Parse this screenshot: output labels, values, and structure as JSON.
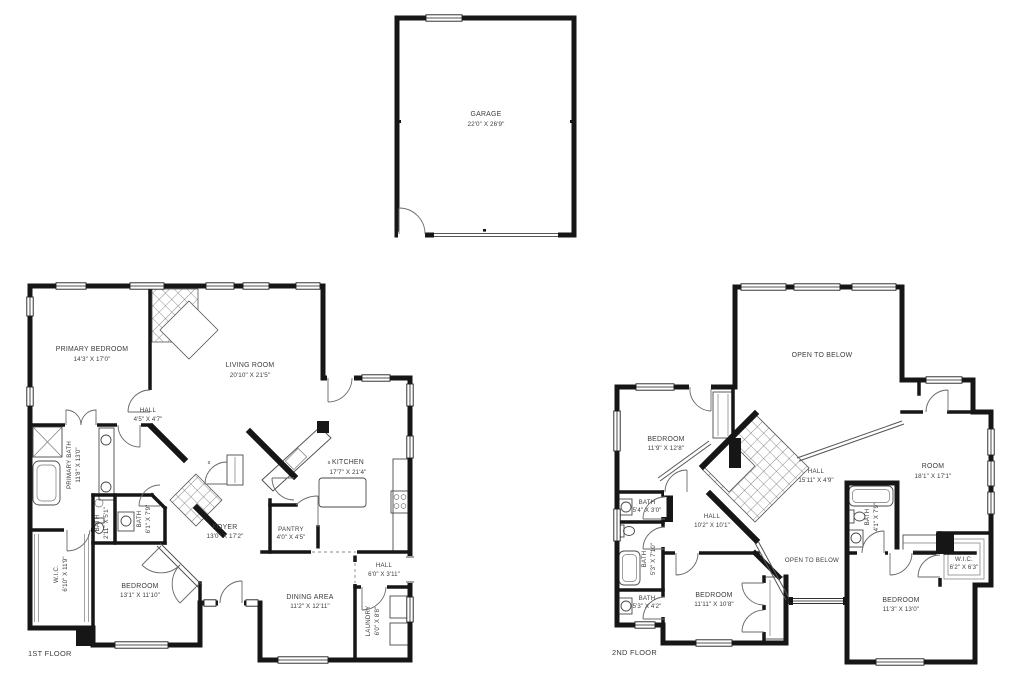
{
  "colors": {
    "wall": "#161616",
    "label": "#3c3c3c",
    "background": "#ffffff"
  },
  "garage": {
    "name": "GARAGE",
    "dims": "22'0\" X 26'9\""
  },
  "floor1": {
    "title": "1ST FLOOR",
    "rooms": {
      "primary_bedroom": {
        "name": "PRIMARY BEDROOM",
        "dims": "14'3\" X 17'0\""
      },
      "living_room": {
        "name": "LIVING ROOM",
        "dims": "20'10\" X 21'5\""
      },
      "hall_small": {
        "name": "HALL",
        "dims": "4'5\" X 4'7\""
      },
      "primary_bath": {
        "name": "PRIMARY BATH",
        "dims": "11'8\" X 13'0\""
      },
      "bath_small": {
        "name": "BATH",
        "dims": "2'11\" X 5'1\""
      },
      "bath_hall": {
        "name": "BATH",
        "dims": "6'1\" X 7'9\""
      },
      "kitchen": {
        "name": "KITCHEN",
        "dims": "17'7\" X 21'4\""
      },
      "foyer": {
        "name": "FOYER",
        "dims": "13'0\" X 17'2\""
      },
      "pantry": {
        "name": "PANTRY",
        "dims": "4'0\" X 4'5\""
      },
      "wic": {
        "name": "W.I.C.",
        "dims": "6'10\" X 11'9\""
      },
      "bedroom": {
        "name": "BEDROOM",
        "dims": "13'1\" X 11'10\""
      },
      "hall_rear": {
        "name": "HALL",
        "dims": "6'0\" X 3'11\""
      },
      "dining": {
        "name": "DINING AREA",
        "dims": "11'2\" X 12'11\""
      },
      "laundry": {
        "name": "LAUNDRY",
        "dims": "6'0\" X 8'8\""
      }
    },
    "markers": {
      "s1": "s",
      "s2": "s"
    }
  },
  "floor2": {
    "title": "2ND FLOOR",
    "rooms": {
      "open_below_top": {
        "name": "OPEN TO BELOW"
      },
      "bedroom_nw": {
        "name": "BEDROOM",
        "dims": "11'9\" X 12'8\""
      },
      "hall_landing": {
        "name": "HALL",
        "dims": "15'11\" X 4'9\""
      },
      "room": {
        "name": "ROOM",
        "dims": "18'1\" X 17'1\""
      },
      "bath_nw": {
        "name": "BATH",
        "dims": "5'4\" X 3'0\""
      },
      "bath_w": {
        "name": "BATH",
        "dims": "5'3\" X 7'10\""
      },
      "hall_center": {
        "name": "HALL",
        "dims": "10'2\" X 10'1\""
      },
      "bath_sw": {
        "name": "BATH",
        "dims": "5'3\" X 4'2\""
      },
      "bedroom_s": {
        "name": "BEDROOM",
        "dims": "11'11\" X 10'8\""
      },
      "open_below_mid": {
        "name": "OPEN TO BELOW"
      },
      "bath_e": {
        "name": "BATH",
        "dims": "4'1\" X 7'9\""
      },
      "wic": {
        "name": "W.I.C.",
        "dims": "6'2\" X 6'3\""
      },
      "bedroom_se": {
        "name": "BEDROOM",
        "dims": "11'3\" X 13'0\""
      }
    }
  }
}
